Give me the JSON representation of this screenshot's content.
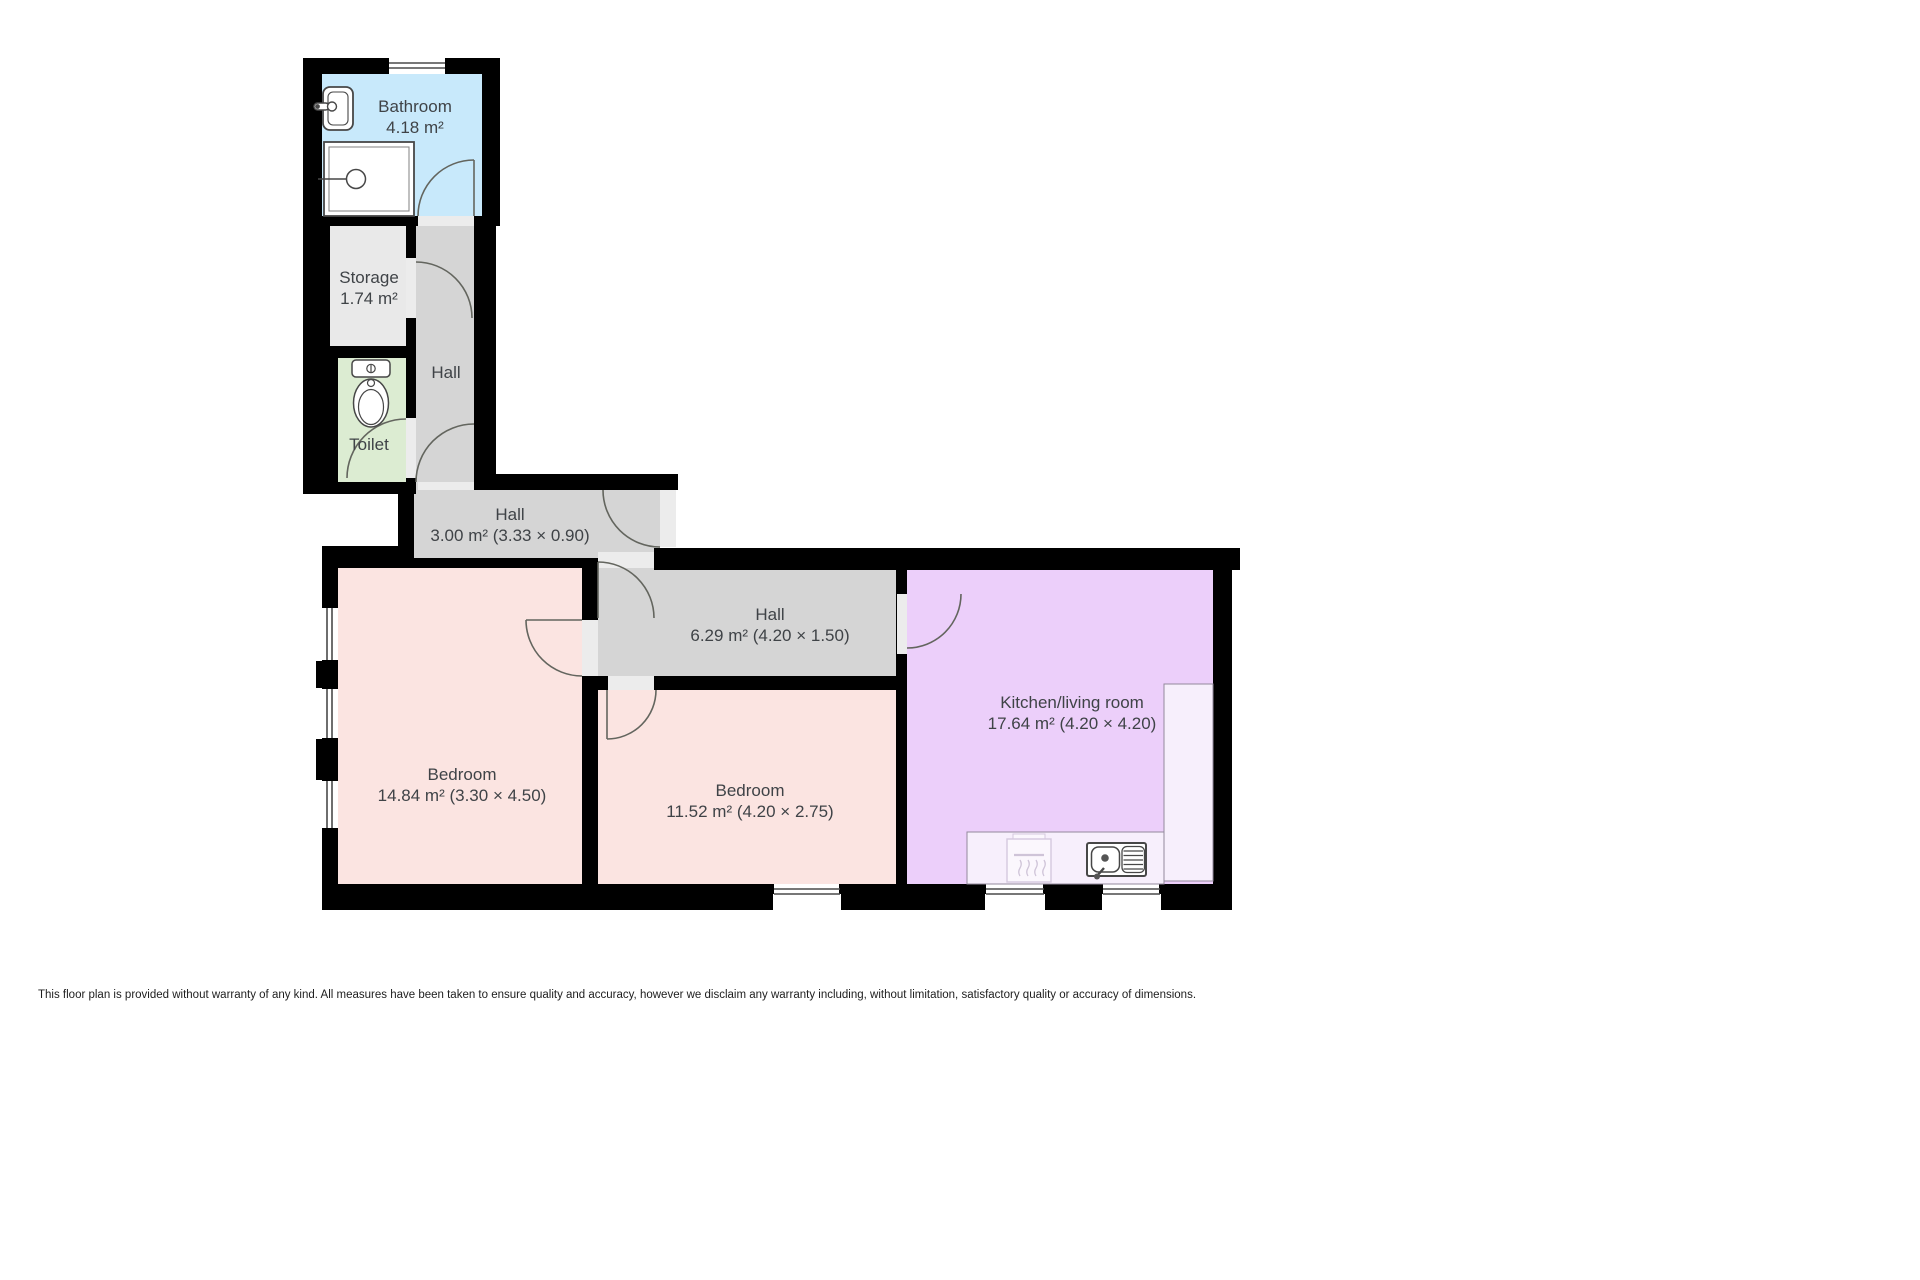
{
  "plan_title": "floor-plan",
  "disclaimer": "This floor plan is provided without warranty of any kind. All measures have been taken to ensure quality and accuracy, however we disclaim any warranty including, without limitation, satisfactory quality or accuracy of dimensions.",
  "colors": {
    "wall": "#000000",
    "bathroom": "#c8e9fb",
    "storage": "#e9e9e9",
    "toilet": "#dcecd2",
    "hall": "#d5d5d5",
    "bedroom": "#fbe4e1",
    "kitchen": "#eccffa",
    "counter": "#f7effc",
    "threshold": "#ececec",
    "label_text": "#3f4347"
  },
  "fixtures": [
    "bathroom-sink",
    "shower",
    "toilet",
    "kitchen-sink",
    "stove",
    "windows",
    "door-swings"
  ],
  "rooms": [
    {
      "id": "bathroom",
      "name": "Bathroom",
      "area": "4.18 m²",
      "color": "#c8e9fb",
      "rect": [
        322,
        74,
        160,
        142
      ],
      "label": [
        415,
        96
      ]
    },
    {
      "id": "storage",
      "name": "Storage",
      "area": "1.74 m²",
      "color": "#e9e9e9",
      "rect": [
        330,
        226,
        78,
        120
      ],
      "label": [
        369,
        267
      ]
    },
    {
      "id": "toilet",
      "name": "Toilet",
      "area": "",
      "color": "#dcecd2",
      "rect": [
        338,
        358,
        68,
        124
      ],
      "label": [
        369,
        434
      ]
    },
    {
      "id": "hall-upper",
      "name": "Hall",
      "area": "",
      "color": "#d5d5d5",
      "rect": [
        416,
        216,
        58,
        274
      ],
      "label": [
        446,
        362
      ]
    },
    {
      "id": "hall-entry",
      "name": "Hall",
      "area": "3.00 m² (3.33 × 0.90)",
      "color": "#d5d5d5",
      "rect": [
        414,
        490,
        246,
        68
      ],
      "label": [
        510,
        504
      ]
    },
    {
      "id": "hall-inner",
      "name": "Hall",
      "area": "6.29 m² (4.20 × 1.50)",
      "color": "#d5d5d5",
      "rect": [
        598,
        568,
        298,
        108
      ],
      "label": [
        770,
        604
      ]
    },
    {
      "id": "bedroom-1",
      "name": "Bedroom",
      "area": "14.84 m² (3.30 × 4.50)",
      "color": "#fbe4e1",
      "rect": [
        338,
        568,
        244,
        316
      ],
      "label": [
        462,
        764
      ]
    },
    {
      "id": "bedroom-2",
      "name": "Bedroom",
      "area": "11.52 m² (4.20 × 2.75)",
      "color": "#fbe4e1",
      "rect": [
        598,
        690,
        298,
        194
      ],
      "label": [
        750,
        780
      ]
    },
    {
      "id": "kitchen",
      "name": "Kitchen/living room",
      "area": "17.64 m² (4.20 × 4.20)",
      "color": "#eccffa",
      "rect": [
        907,
        570,
        306,
        314
      ],
      "label": [
        1072,
        692
      ]
    }
  ]
}
